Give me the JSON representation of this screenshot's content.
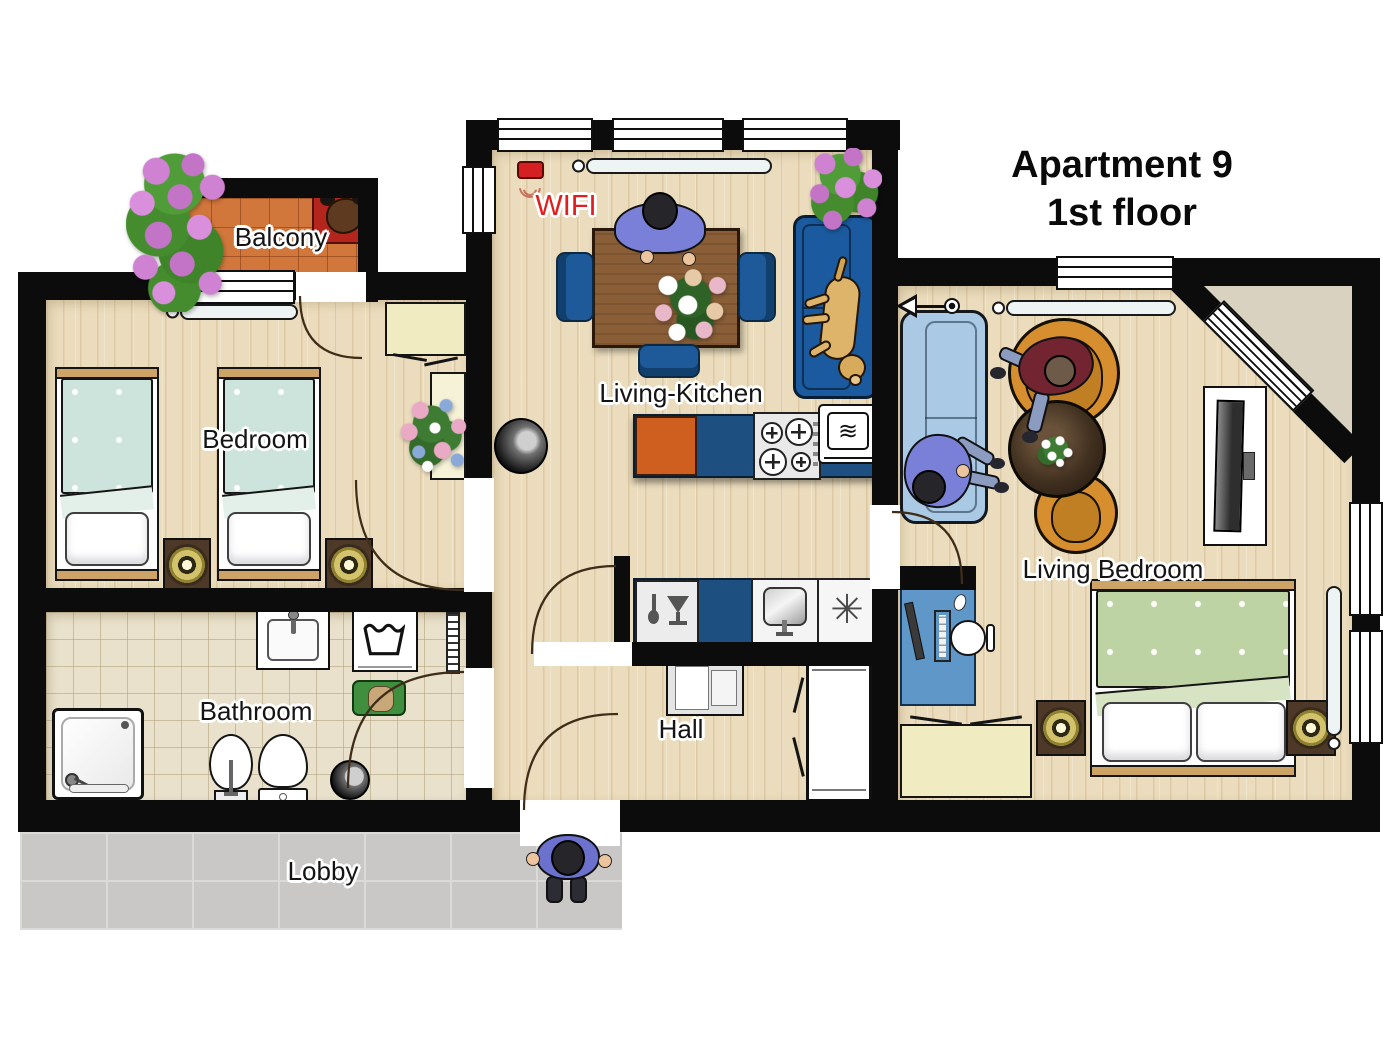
{
  "title": {
    "line1": "Apartment 9",
    "line2": "1st floor"
  },
  "rooms": {
    "balcony": {
      "label": "Balcony",
      "items": [
        "flower-bush",
        "dog-bed",
        "sleeping-dog"
      ]
    },
    "bedroom": {
      "label": "Bedroom",
      "items": [
        "single-bed",
        "single-bed",
        "nightstand-lamp",
        "nightstand-lamp",
        "wardrobe",
        "side-table",
        "flower-bouquet",
        "radiator"
      ]
    },
    "bathroom": {
      "label": "Bathroom",
      "items": [
        "shower",
        "washbasin",
        "washing-machine",
        "laundry-basket",
        "bidet",
        "toilet",
        "stool",
        "radiator"
      ]
    },
    "hall": {
      "label": "Hall",
      "items": [
        "console-table",
        "wardrobe"
      ]
    },
    "living_kitchen": {
      "label": "Living-Kitchen",
      "items": [
        "wifi-router",
        "radiator",
        "dining-table",
        "dining-chair",
        "dining-chair",
        "dining-chair",
        "person-at-table",
        "flower-bouquet",
        "sofa",
        "dog-on-sofa",
        "flower-bush",
        "cabinet-orange",
        "cabinet-blue",
        "stove",
        "microwave",
        "dishwasher",
        "kitchen-sink",
        "freezer",
        "pouf"
      ]
    },
    "living_bedroom": {
      "label": "Living Bedroom",
      "items": [
        "floor-lamp",
        "radiator",
        "sofa",
        "person-on-sofa",
        "armchair",
        "armchair",
        "person-in-armchair",
        "coffee-table",
        "tv-board",
        "double-bed",
        "nightstand-lamp",
        "nightstand-lamp",
        "computer-desk",
        "office-chair",
        "chest",
        "radiator"
      ]
    },
    "lobby": {
      "label": "Lobby",
      "items": [
        "walking-person"
      ]
    }
  },
  "annotations": {
    "wifi": "WIFI"
  },
  "glyphs": {
    "freezer": "✳",
    "microwave": "≋"
  },
  "colors": {
    "wall": "#0c0c0c",
    "wood_floor": "#eadcbc",
    "bathroom_tile": "#e9e1cb",
    "balcony_tile": "#d2773b",
    "lobby_tile": "#c9c8c6",
    "kitchen_counter_blue": "#1d4f80",
    "cabinet_orange": "#cf5f1f",
    "sofa_blue": "#1b5a9e",
    "sofa_light_blue": "#aac9e4",
    "armchair_orange": "#d68e2e",
    "bed_teal": "#cde4dd",
    "bed_green": "#bdd3a3",
    "wifi_red": "#e21d1d",
    "person_purple": "#7a80d8",
    "dog_golden": "#ddb469",
    "table_wood": "#8a5f38",
    "furniture_yellow": "#f0ebc0"
  }
}
